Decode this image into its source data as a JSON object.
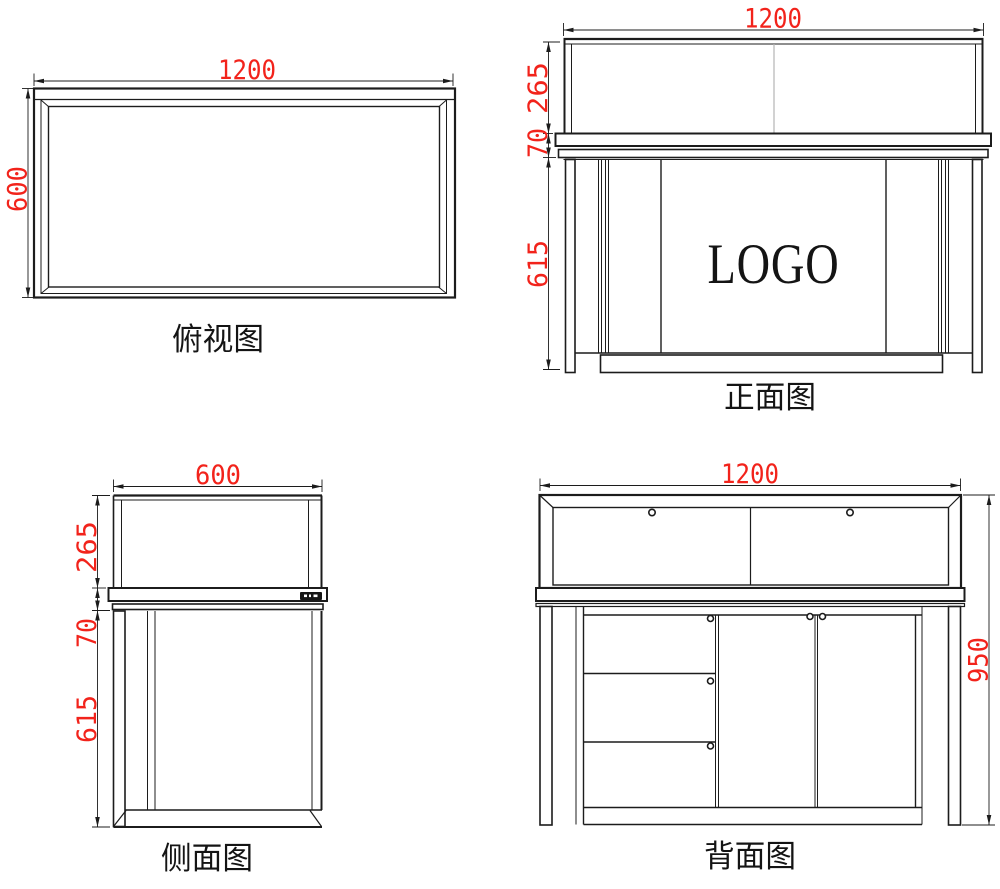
{
  "drawing": {
    "background": "#ffffff",
    "line_color": "#1c1c1c",
    "dimension_color": "#f2231b",
    "views": {
      "top": {
        "title": "俯视图",
        "width_label": "1200",
        "depth_label": "600"
      },
      "front": {
        "title": "正面图",
        "width_label": "1200",
        "height_labels": [
          "265",
          "70",
          "615"
        ],
        "logo_text": "LOGO"
      },
      "side": {
        "title": "侧面图",
        "width_label": "600",
        "height_labels": [
          "265",
          "70",
          "615"
        ]
      },
      "back": {
        "title": "背面图",
        "width_label": "1200",
        "height_label": "950"
      }
    }
  }
}
